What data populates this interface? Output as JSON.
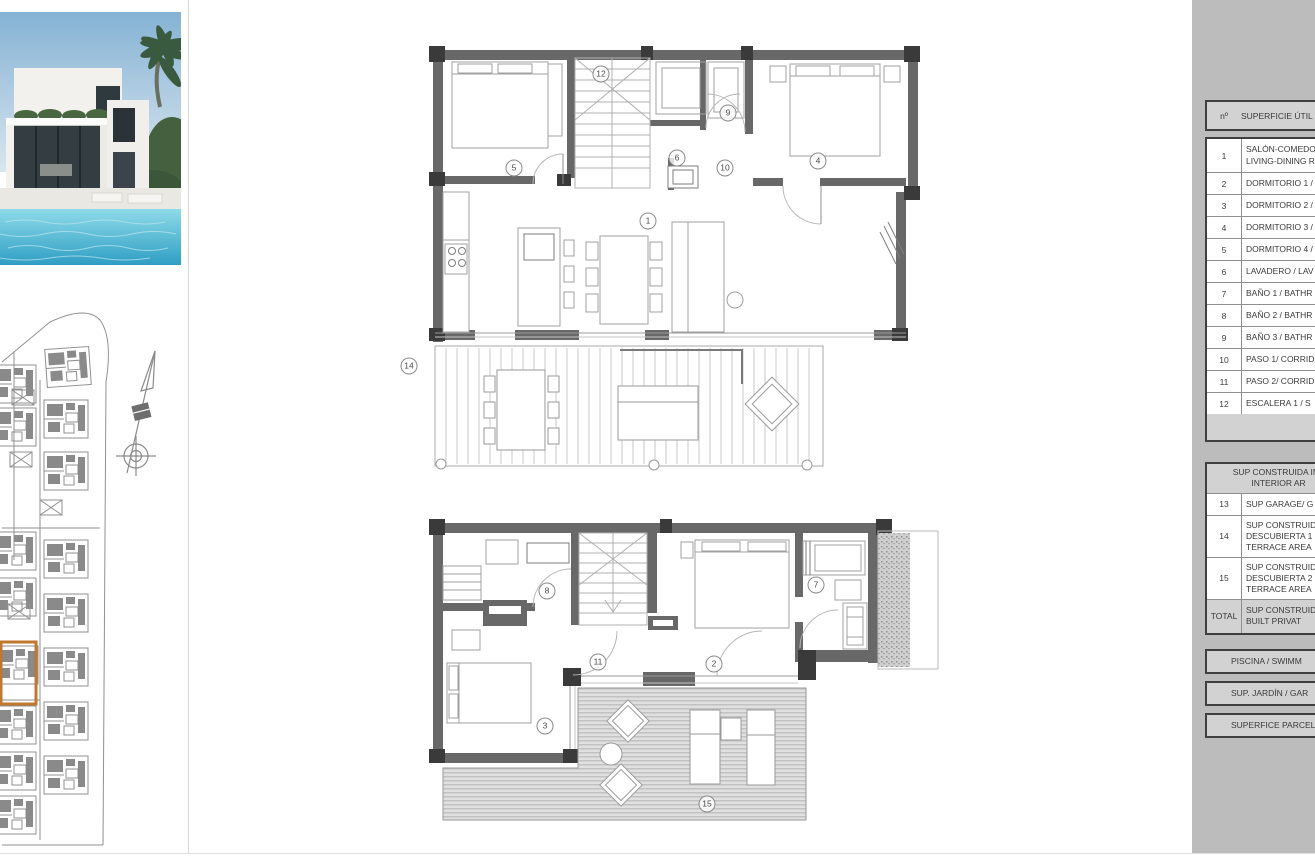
{
  "colors": {
    "panel_bg": "#bcbcbc",
    "table_header_bg": "#d2d2d2",
    "table_border_dark": "#3f3f3f",
    "table_border_light": "#8f8f8f",
    "wall_gray": "#686868",
    "wall_dark": "#3a3a3a",
    "highlight_orange": "#c0772e",
    "pool_blue": "#35a8cc",
    "sky_blue": "#85b2d4"
  },
  "area_table": {
    "header": {
      "num": "nº",
      "label": "SUPERFICIE ÚTIL"
    },
    "rows": [
      {
        "n": "1",
        "lines": [
          "SALÓN-COMEDOR",
          "LIVING-DINING R"
        ]
      },
      {
        "n": "2",
        "lines": [
          "DORMITORIO 1 /"
        ]
      },
      {
        "n": "3",
        "lines": [
          "DORMITORIO 2 /"
        ]
      },
      {
        "n": "4",
        "lines": [
          "DORMITORIO 3 /"
        ]
      },
      {
        "n": "5",
        "lines": [
          "DORMITORIO 4 /"
        ]
      },
      {
        "n": "6",
        "lines": [
          "LAVADERO / LAV"
        ]
      },
      {
        "n": "7",
        "lines": [
          "BAÑO 1 / BATHR"
        ]
      },
      {
        "n": "8",
        "lines": [
          "BAÑO 2 / BATHR"
        ]
      },
      {
        "n": "9",
        "lines": [
          "BAÑO 3 / BATHR"
        ]
      },
      {
        "n": "10",
        "lines": [
          "PASO 1/ CORRID"
        ]
      },
      {
        "n": "11",
        "lines": [
          "PASO 2/ CORRID"
        ]
      },
      {
        "n": "12",
        "lines": [
          "ESCALERA 1 / S"
        ]
      }
    ],
    "section2_header_lines": [
      "SUP CONSTRUIDA INT",
      "INTERIOR AR"
    ],
    "rows2": [
      {
        "n": "13",
        "lines": [
          "SUP GARAGE/ G"
        ]
      },
      {
        "n": "14",
        "lines": [
          "SUP CONSTRUID",
          "DESCUBIERTA 1",
          "TERRACE AREA"
        ]
      },
      {
        "n": "15",
        "lines": [
          "SUP CONSTRUID",
          "DESCUBIERTA 2",
          "TERRACE AREA"
        ]
      },
      {
        "n": "TOTAL",
        "lines": [
          "SUP CONSTRUIDA",
          "BUILT PRIVAT"
        ],
        "gray": true
      }
    ],
    "bars": [
      "PISCINA / SWIMM",
      "SUP. JARDÍN / GAR",
      "SUPERFICE PARCELA"
    ]
  },
  "floor_plans": {
    "upper_markers": [
      {
        "n": "5",
        "x": 514,
        "y": 168
      },
      {
        "n": "12",
        "x": 601,
        "y": 74
      },
      {
        "n": "6",
        "x": 677,
        "y": 158
      },
      {
        "n": "9",
        "x": 728,
        "y": 113
      },
      {
        "n": "10",
        "x": 725,
        "y": 168
      },
      {
        "n": "4",
        "x": 818,
        "y": 161
      },
      {
        "n": "1",
        "x": 648,
        "y": 221
      },
      {
        "n": "14",
        "x": 409,
        "y": 366
      }
    ],
    "lower_markers": [
      {
        "n": "8",
        "x": 547,
        "y": 591
      },
      {
        "n": "7",
        "x": 816,
        "y": 585
      },
      {
        "n": "11",
        "x": 598,
        "y": 662
      },
      {
        "n": "2",
        "x": 714,
        "y": 664
      },
      {
        "n": "3",
        "x": 545,
        "y": 726
      },
      {
        "n": "15",
        "x": 707,
        "y": 804
      }
    ]
  }
}
